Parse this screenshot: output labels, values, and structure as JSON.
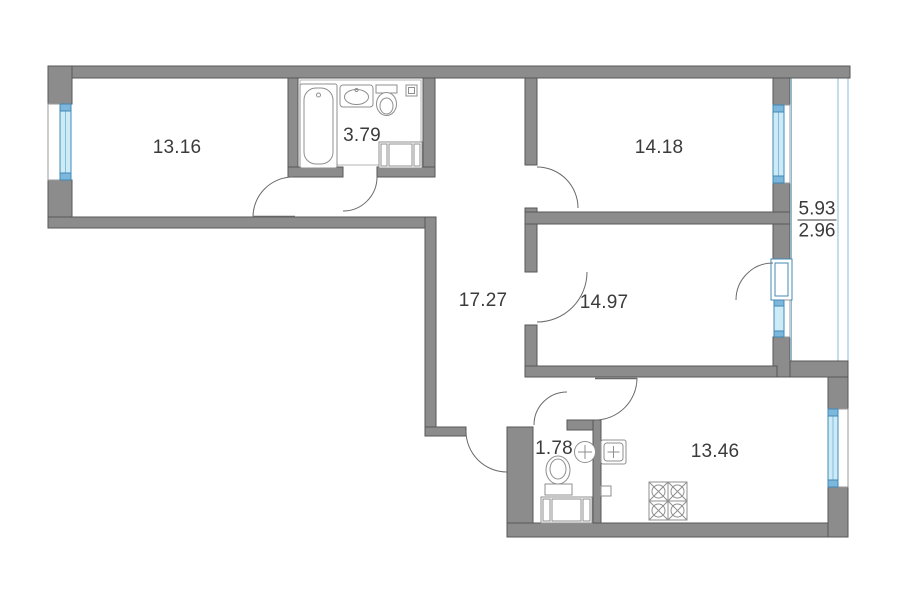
{
  "floor_plan": {
    "rooms": {
      "living_room_1": {
        "area": "13.16"
      },
      "bathroom": {
        "area": "3.79"
      },
      "living_room_2": {
        "area": "14.18"
      },
      "hallway": {
        "area": "17.27"
      },
      "living_room_3": {
        "area": "14.97"
      },
      "wc": {
        "area": "1.78"
      },
      "kitchen": {
        "area": "13.46"
      },
      "balcony": {
        "area_full": "5.93",
        "area_reduced": "2.96"
      }
    },
    "colors": {
      "wall": "#8c8c8c",
      "wall-stroke": "#575757",
      "window": "#cdeaf7",
      "window-stroke": "#4189b5",
      "window-cap": "#7db8dc",
      "balcony-line": "#85bcd9",
      "fixture": "#8f8f8f",
      "text": "#3b3b3b"
    }
  }
}
